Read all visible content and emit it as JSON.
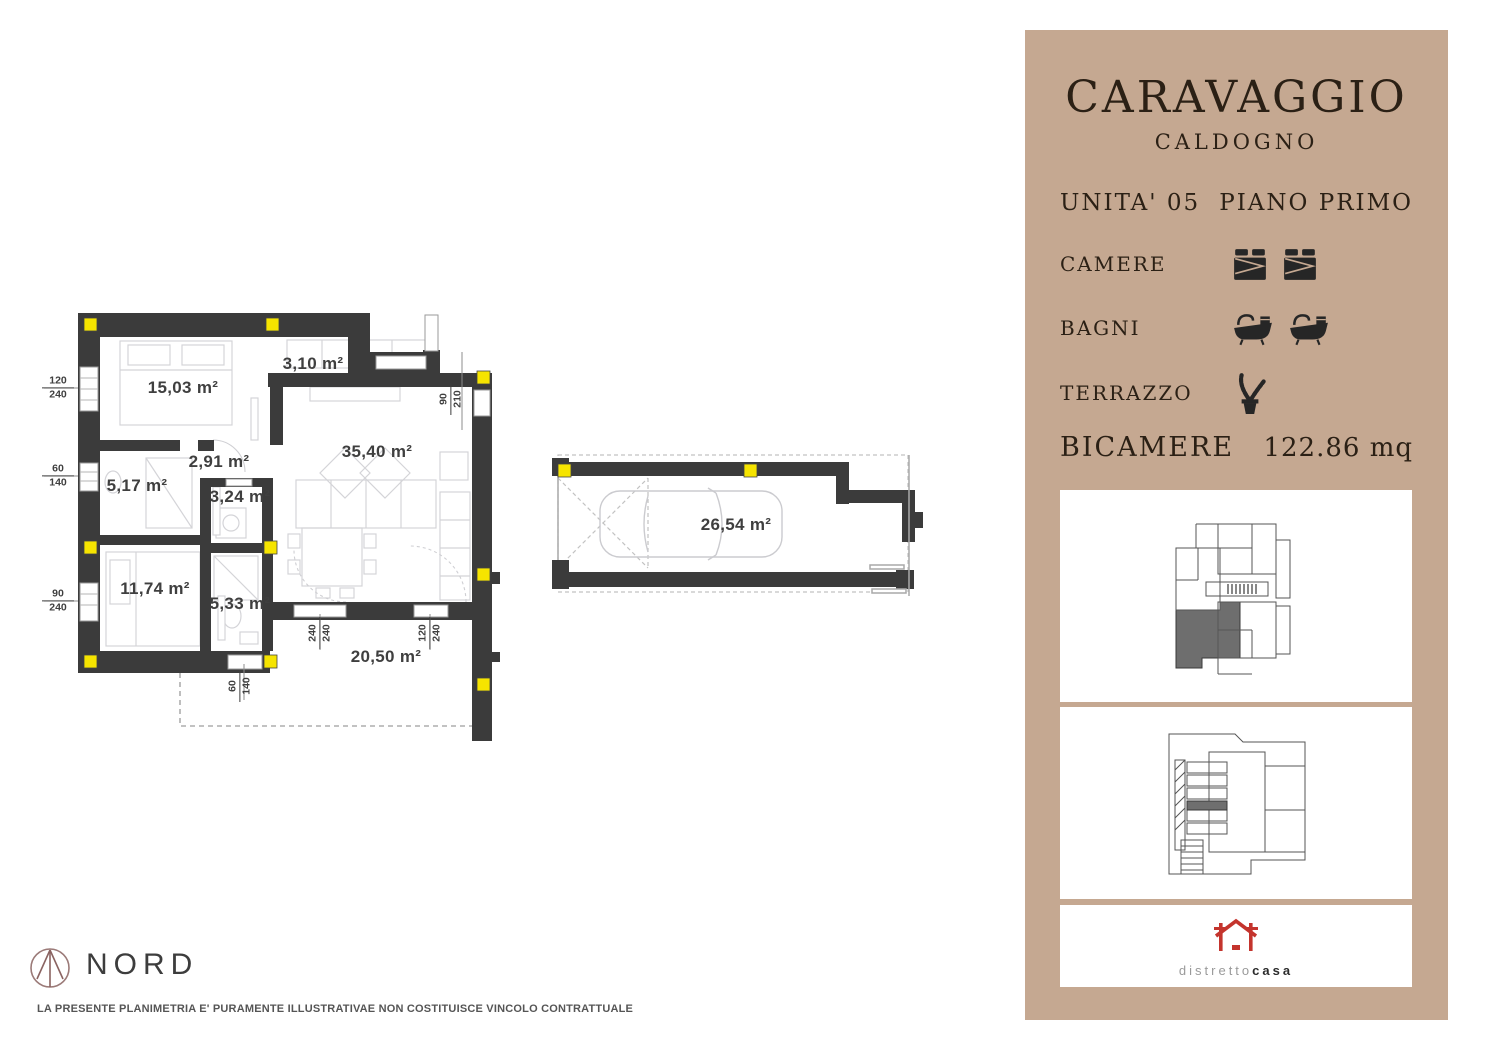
{
  "plan": {
    "rooms": [
      {
        "name": "bedroom-1",
        "area": "15,03 m²"
      },
      {
        "name": "balcony",
        "area": "3,10 m²"
      },
      {
        "name": "hallway",
        "area": "2,91 m²"
      },
      {
        "name": "bathroom-1",
        "area": "5,17 m²"
      },
      {
        "name": "bathroom-2",
        "area": "3,24 m²"
      },
      {
        "name": "living-room",
        "area": "35,40 m²"
      },
      {
        "name": "bedroom-2",
        "area": "11,74 m²"
      },
      {
        "name": "bathroom-3",
        "area": "5,33 m²"
      },
      {
        "name": "terrace",
        "area": "20,50 m²"
      },
      {
        "name": "garage",
        "area": "26,54 m²"
      }
    ],
    "dims": [
      {
        "top": "120",
        "bottom": "240"
      },
      {
        "top": "60",
        "bottom": "140"
      },
      {
        "top": "90",
        "bottom": "240"
      },
      {
        "top": "90",
        "bottom": "210"
      },
      {
        "top": "240",
        "bottom": "240"
      },
      {
        "top": "120",
        "bottom": "240"
      },
      {
        "top": "60",
        "bottom": "140"
      }
    ],
    "north_label": "NORD",
    "disclaimer": "LA PRESENTE PLANIMETRIA E' PURAMENTE ILLUSTRATIVAE NON COSTITUISCE VINCOLO CONTRATTUALE"
  },
  "panel": {
    "title": "CARAVAGGIO",
    "subtitle": "CALDOGNO",
    "unit_label": "UNITA' 05",
    "floor_label": "PIANO PRIMO",
    "features": [
      {
        "label": "CAMERE",
        "icon": "bed-icon",
        "count": 2
      },
      {
        "label": "BAGNI",
        "icon": "bathtub-icon",
        "count": 2
      },
      {
        "label": "TERRAZZO",
        "icon": "plant-icon",
        "count": 1
      }
    ],
    "type_label": "BICAMERE",
    "size_label": "122.86 mq",
    "logo": {
      "brand_light": "distretto",
      "brand_bold": "casa"
    }
  },
  "colors": {
    "panel_background": "#c5a891",
    "wall": "#3b3b3b",
    "highlight_yellow": "#f6e400",
    "logo_red": "#c4342d",
    "compass": "#9b7a78"
  }
}
